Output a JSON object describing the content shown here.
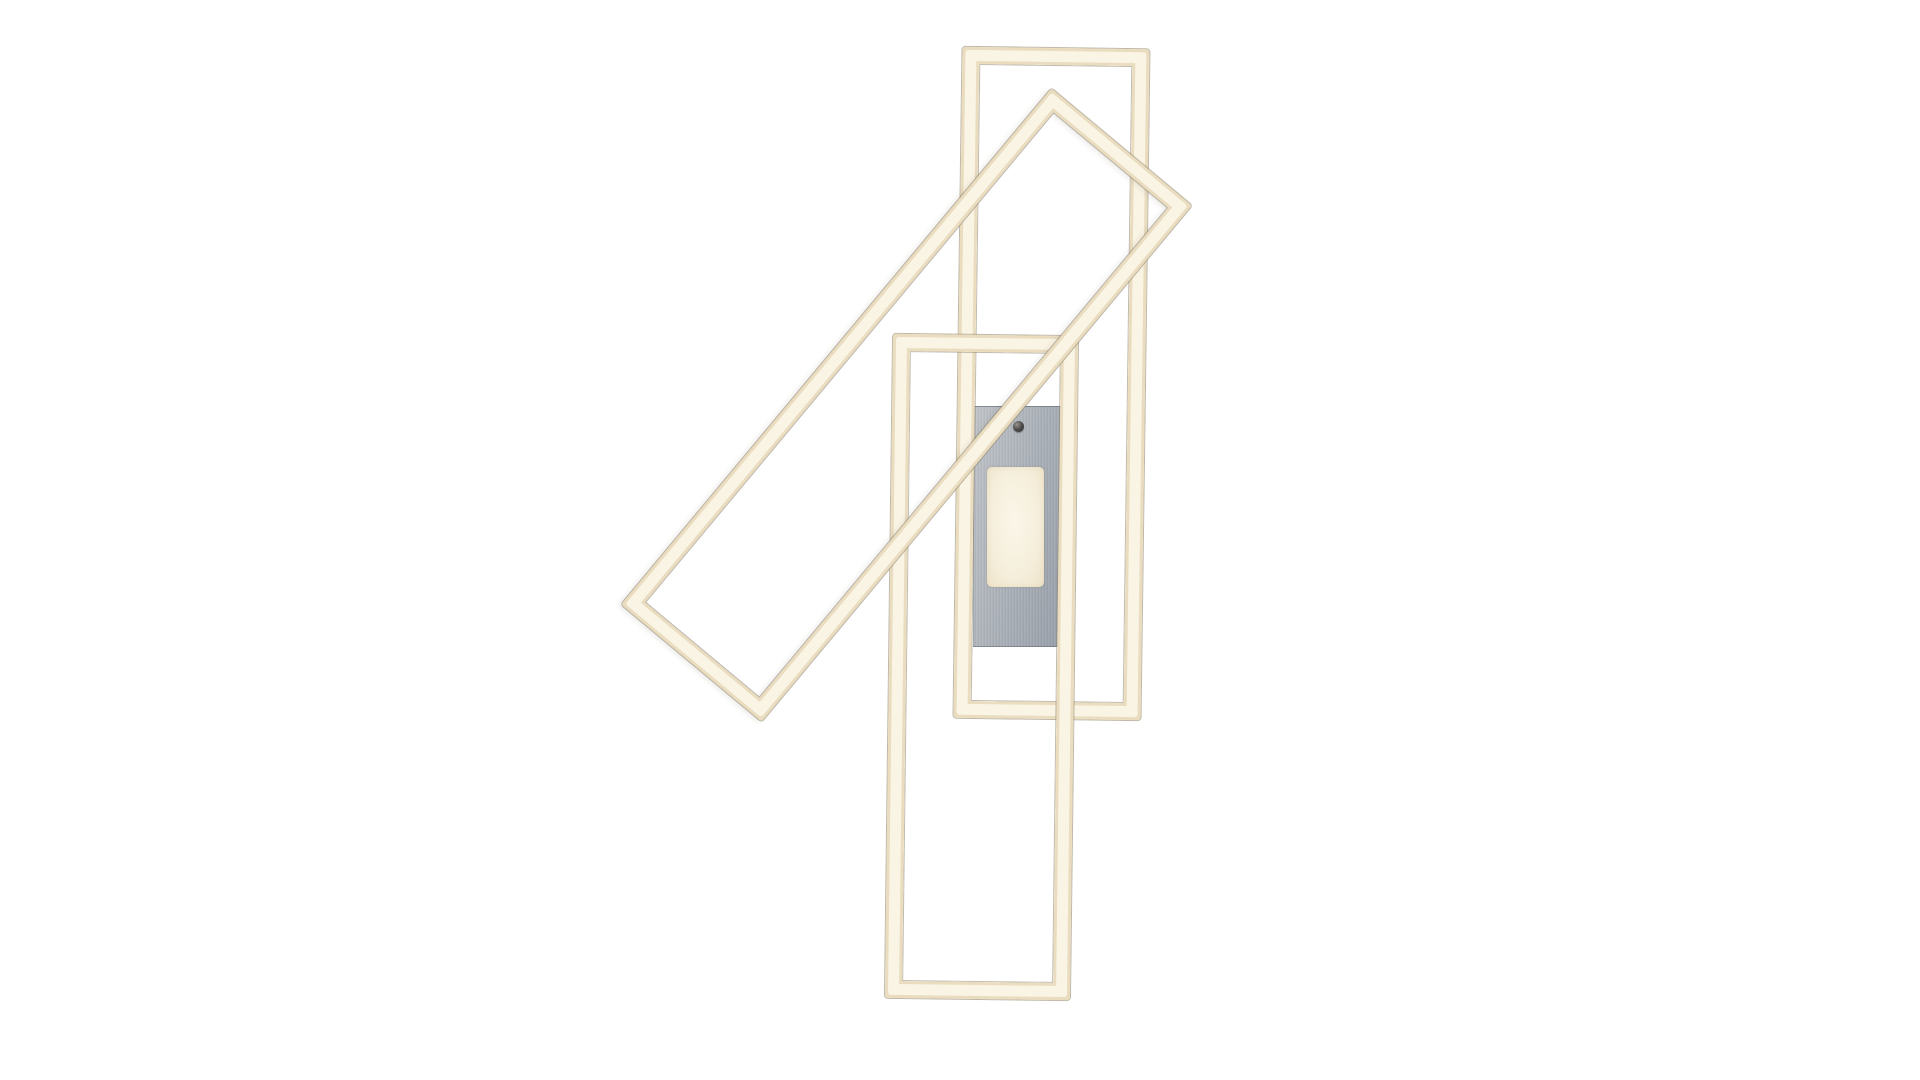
{
  "scene": {
    "type": "product-photo",
    "subject": "LED ceiling light with three overlapping rectangular LED frames on a brushed aluminium canopy plate",
    "text_content": [],
    "colors": {
      "background": "#ffffff",
      "frame_edge": "#e9dcbf",
      "frame_core": "#faf4e5",
      "frame_hairline_outer": "rgba(148,136,112,0.6)",
      "frame_hairline_inner": "rgba(140,130,110,0.55)",
      "plate_light": "#c2c6cb",
      "plate_mid": "#aeb4bb",
      "plate_dark": "#99a0aa",
      "panel_core": "#fbf6e9",
      "panel_edge": "#efe4cb",
      "screw_dark": "#35342f"
    },
    "parts": [
      {
        "name": "mounting-plate",
        "shape": "rectangle",
        "x": 973,
        "y": 406,
        "w": 91,
        "h": 241
      },
      {
        "name": "led-panel",
        "shape": "rounded-rectangle",
        "x": 987,
        "y": 467,
        "w": 57,
        "h": 120
      },
      {
        "name": "mounting-screw",
        "shape": "circle",
        "x": 1012.5,
        "y": 420.5,
        "w": 11,
        "h": 11
      },
      {
        "name": "frame-upright-top",
        "shape": "rectangle-outline",
        "x": 957.5,
        "y": 47.5,
        "w": 187,
        "h": 671,
        "rotation_deg": 0.77,
        "bar_thickness": 17
      },
      {
        "name": "frame-upright-bottom",
        "shape": "rectangle-outline",
        "x": 888.9,
        "y": 335.1,
        "w": 185,
        "h": 664,
        "rotation_deg": 0.7,
        "bar_thickness": 17
      },
      {
        "name": "frame-tilted",
        "shape": "rectangle-outline",
        "x": 814.5,
        "y": 69,
        "w": 183,
        "h": 672,
        "rotation_deg": 39.82,
        "bar_thickness": 17
      }
    ]
  }
}
